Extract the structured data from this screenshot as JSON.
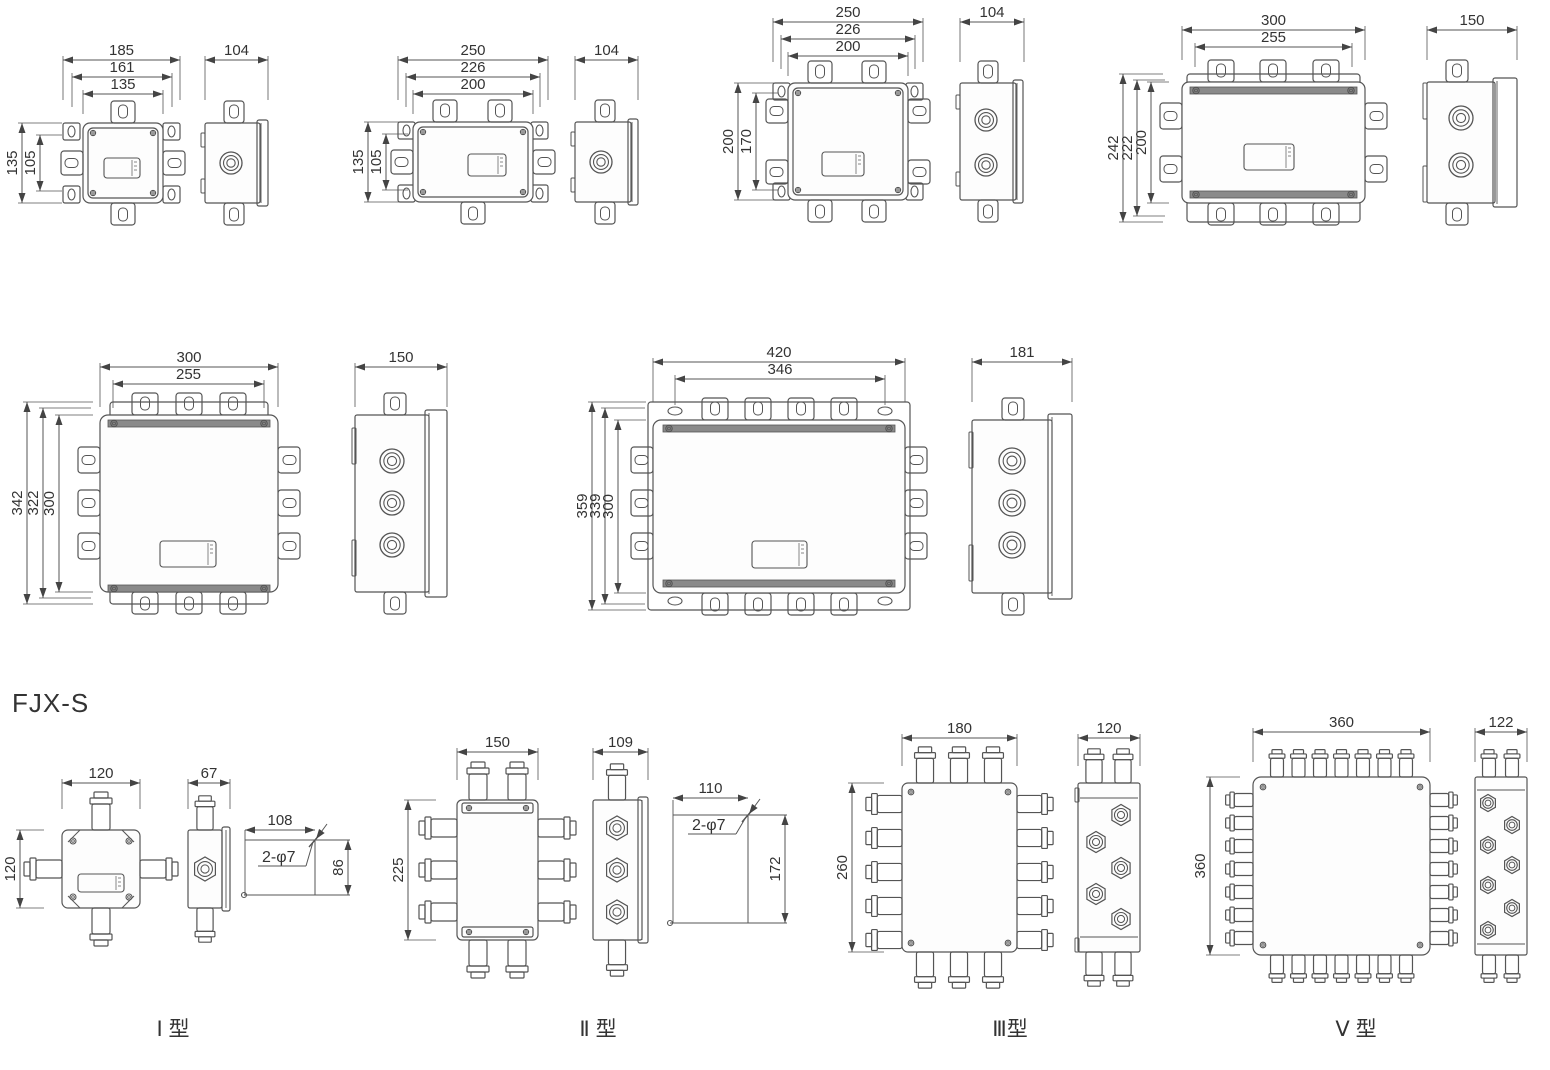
{
  "page": {
    "series_label": "FJX-S"
  },
  "colors": {
    "line": "#555555",
    "text": "#333333",
    "background": "#ffffff",
    "strip": "#8a8a8a"
  },
  "top_row": [
    {
      "top": [
        "185",
        "161",
        "135"
      ],
      "left": [
        "135",
        "105"
      ],
      "side_top": [
        "104"
      ]
    },
    {
      "top": [
        "250",
        "226",
        "200"
      ],
      "left": [
        "135",
        "105"
      ],
      "side_top": [
        "104"
      ]
    },
    {
      "top": [
        "250",
        "226",
        "200"
      ],
      "left": [
        "200",
        "170"
      ],
      "side_top": [
        "104"
      ]
    },
    {
      "top": [
        "300",
        "255"
      ],
      "left": [
        "242",
        "222",
        "200"
      ],
      "side_top": [
        "150"
      ]
    }
  ],
  "middle_row": [
    {
      "top": [
        "300",
        "255"
      ],
      "left": [
        "342",
        "322",
        "300"
      ],
      "side_top": [
        "150"
      ]
    },
    {
      "top": [
        "420",
        "346"
      ],
      "left": [
        "359",
        "339",
        "300"
      ],
      "side_top": [
        "181"
      ]
    }
  ],
  "fjx_s_row": [
    {
      "label": "Ⅰ 型",
      "top": [
        "120"
      ],
      "left": [
        "120"
      ],
      "side_top": [
        "67"
      ],
      "mount": {
        "w": "108",
        "h": "86",
        "holes": "2-φ7"
      }
    },
    {
      "label": "Ⅱ 型",
      "top": [
        "150"
      ],
      "left": [
        "225"
      ],
      "side_top": [
        "109"
      ],
      "mount": {
        "w": "110",
        "h": "172",
        "holes": "2-φ7"
      }
    },
    {
      "label": "Ⅲ型",
      "top": [
        "180"
      ],
      "left": [
        "260"
      ],
      "side_top": [
        "120"
      ]
    },
    {
      "label": "Ⅴ 型",
      "top": [
        "360"
      ],
      "left": [
        "360"
      ],
      "side_top": [
        "122"
      ]
    }
  ]
}
